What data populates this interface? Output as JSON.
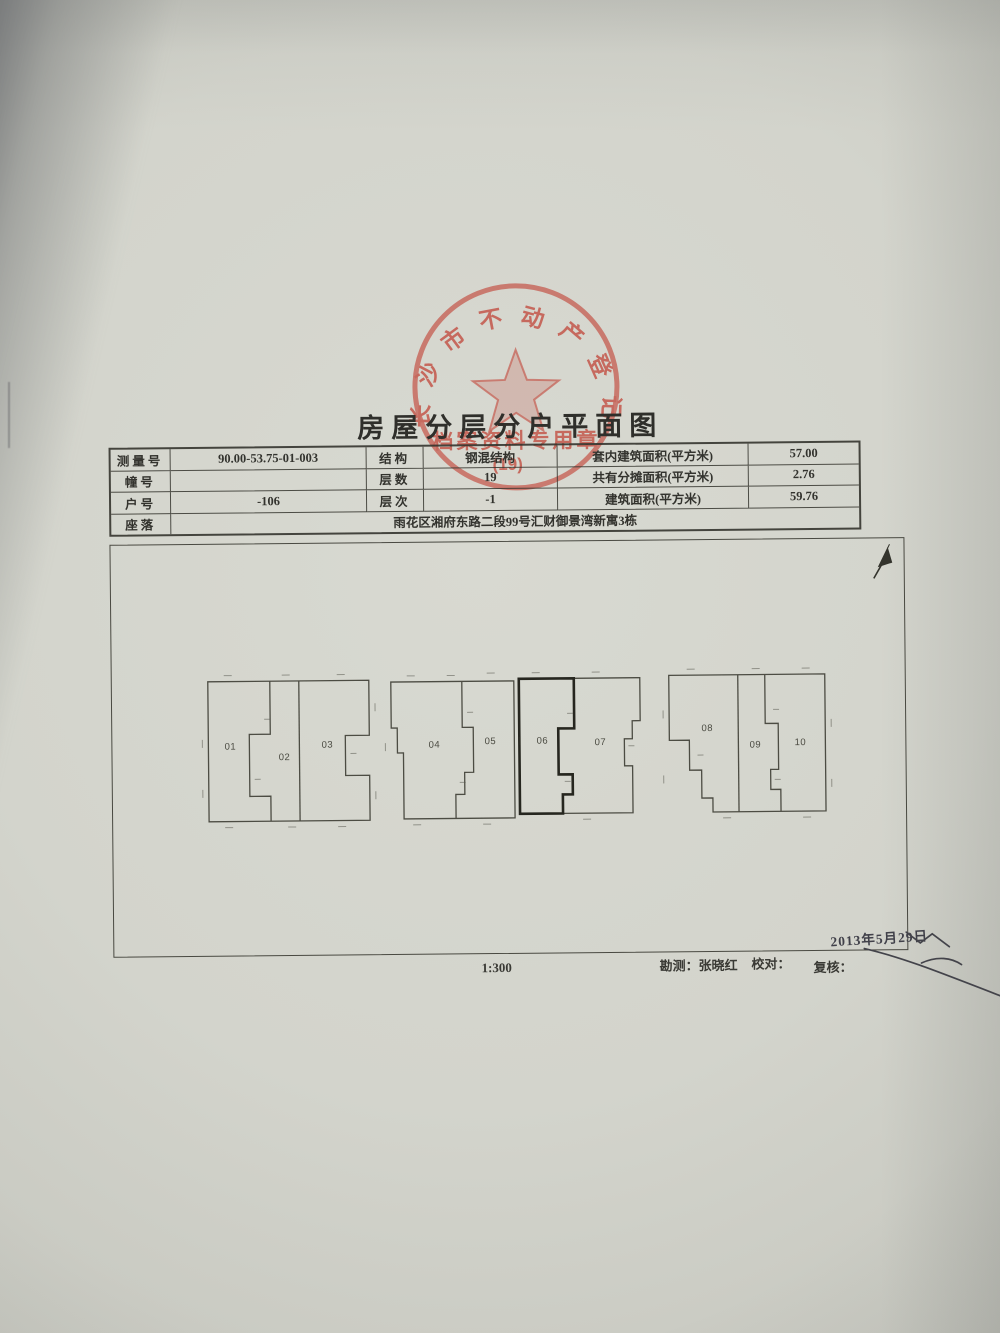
{
  "document": {
    "title": "房屋分层分户平面图",
    "stamp": {
      "arc_text": "长沙市不动产登记中心",
      "line_text": "档案资料专用章",
      "number": "(19)",
      "color": "#c24a3d"
    },
    "info_table": {
      "rows": [
        {
          "l1": "测量号",
          "v1": "90.00-53.75-01-003",
          "l2": "结构",
          "v2": "钢混结构",
          "l3": "套内建筑面积(平方米)",
          "v3": "57.00"
        },
        {
          "l1": "幢号",
          "v1": "",
          "l2": "层数",
          "v2": "19",
          "l3": "共有分摊面积(平方米)",
          "v3": "2.76"
        },
        {
          "l1": "户号",
          "v1": "-106",
          "l2": "层次",
          "v2": "-1",
          "l3": "建筑面积(平方米)",
          "v3": "59.76"
        }
      ],
      "location_label": "座落",
      "location_value": "雨花区湘府东路二段99号汇财御景湾新寓3栋"
    },
    "plan": {
      "units": [
        "01",
        "02",
        "03",
        "04",
        "05",
        "06",
        "07",
        "08",
        "09",
        "10"
      ],
      "highlighted_unit": "06",
      "scale": "1:300",
      "date": "2013年5月29日",
      "survey_label": "勘测：",
      "surveyor_name": "张晓红",
      "proofread_label": "校对：",
      "review_label": "复核："
    }
  }
}
